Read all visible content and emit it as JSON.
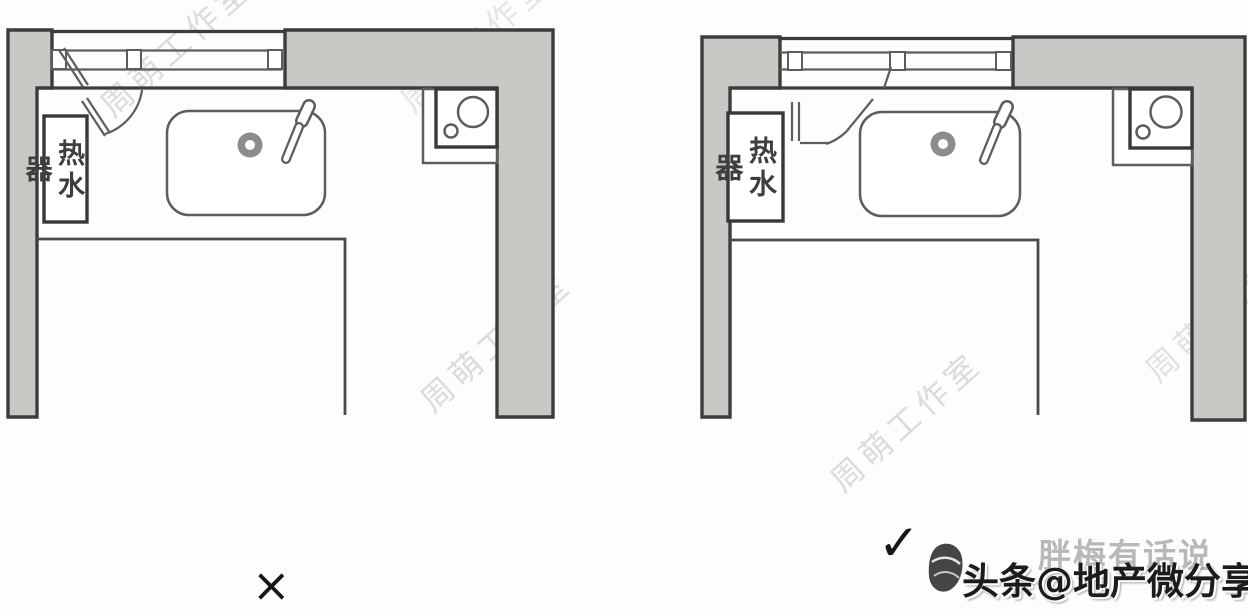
{
  "canvas": {
    "width": 1248,
    "height": 616,
    "background": "#fdfdfd"
  },
  "colors": {
    "wall-fill": "#cac8c5",
    "wall-line": "#3c3c3c",
    "fixture-line": "#5d5d5d",
    "counter-line": "#4a4a4a",
    "watermark": "#c4c0bd",
    "verdict": "#171717",
    "credit-text": "#1b1b1b",
    "account-watermark": "#a9a7a5",
    "logo": "#454545"
  },
  "left_plan": {
    "name": "incorrect-layout",
    "water_heater_label": "热水器",
    "verdict_mark": "×"
  },
  "right_plan": {
    "name": "correct-layout",
    "water_heater_label": "热水器",
    "verdict_mark": "✓"
  },
  "watermarks": {
    "studio_text": "周萌工作室",
    "account_text": "胖梅有话说"
  },
  "footer": {
    "credit_text": "头条@地产微分享"
  }
}
